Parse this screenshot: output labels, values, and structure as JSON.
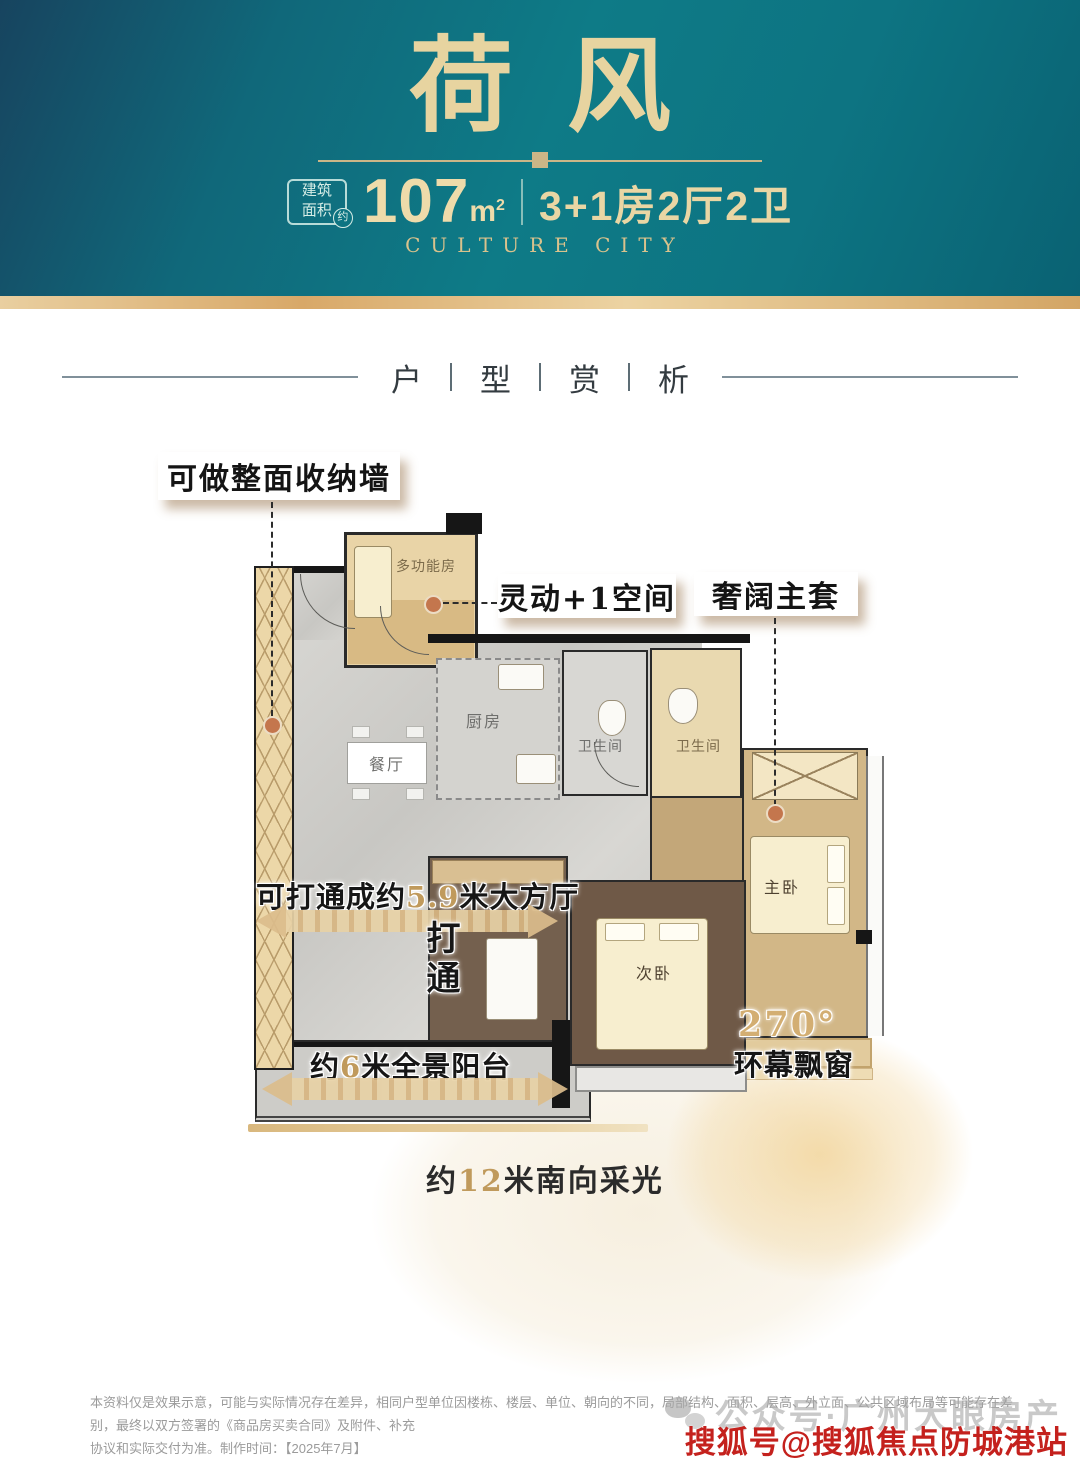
{
  "header": {
    "title": "荷风",
    "area_box": {
      "line1": "建筑",
      "line2": "面积",
      "approx": "约"
    },
    "area_value": "107",
    "area_unit_base": "m",
    "area_unit_sup": "2",
    "spec": "3+1房2厅2卫",
    "subtitle": "CULTURE CITY"
  },
  "section": {
    "c1": "户",
    "c2": "型",
    "c3": "赏",
    "c4": "析"
  },
  "callouts": {
    "storage_wall": "可做整面收纳墙",
    "flex_space": "灵动+1空间",
    "master_suite": "奢阔主套",
    "open_prefix": "可打通成约",
    "open_value": "5.9",
    "open_suffix": "米大方厅",
    "open_through": "打通",
    "balcony_prefix": "约",
    "balcony_value": "6",
    "balcony_suffix": "米全景阳台",
    "bay_degree": "270°",
    "bay_name": "环幕飘窗",
    "light_prefix": "约",
    "light_value": "12",
    "light_suffix": "米南向采光"
  },
  "rooms": {
    "multifunction": "多功能房",
    "kitchen": "厨房",
    "dining": "餐厅",
    "bath1": "卫生间",
    "bath2": "卫生间",
    "master": "主卧",
    "secondary": "次卧"
  },
  "footer": {
    "disclaimer1": "本资料仅是效果示意，可能与实际情况存在差异，相同户型单位因楼栋、楼层、单位、朝向的不同，局部结构、面积、层高、外立面、公共区域布局等可能存在差别，最终以双方签署的《商品房买卖合同》及附件、补充",
    "disclaimer2": "协议和实际交付为准。制作时间：【2025年7月】",
    "watermark_gray": "公众号·广州大眼房产",
    "watermark_red": "搜狐号@搜狐焦点防城港站"
  },
  "colors": {
    "header_teal": "#0e7b87",
    "gold_text": "#e7d4a0",
    "accent_gold": "#c09a5c",
    "tan_room": "#e9d4a7",
    "wall": "#161616",
    "watermark_red": "#c4211d"
  }
}
